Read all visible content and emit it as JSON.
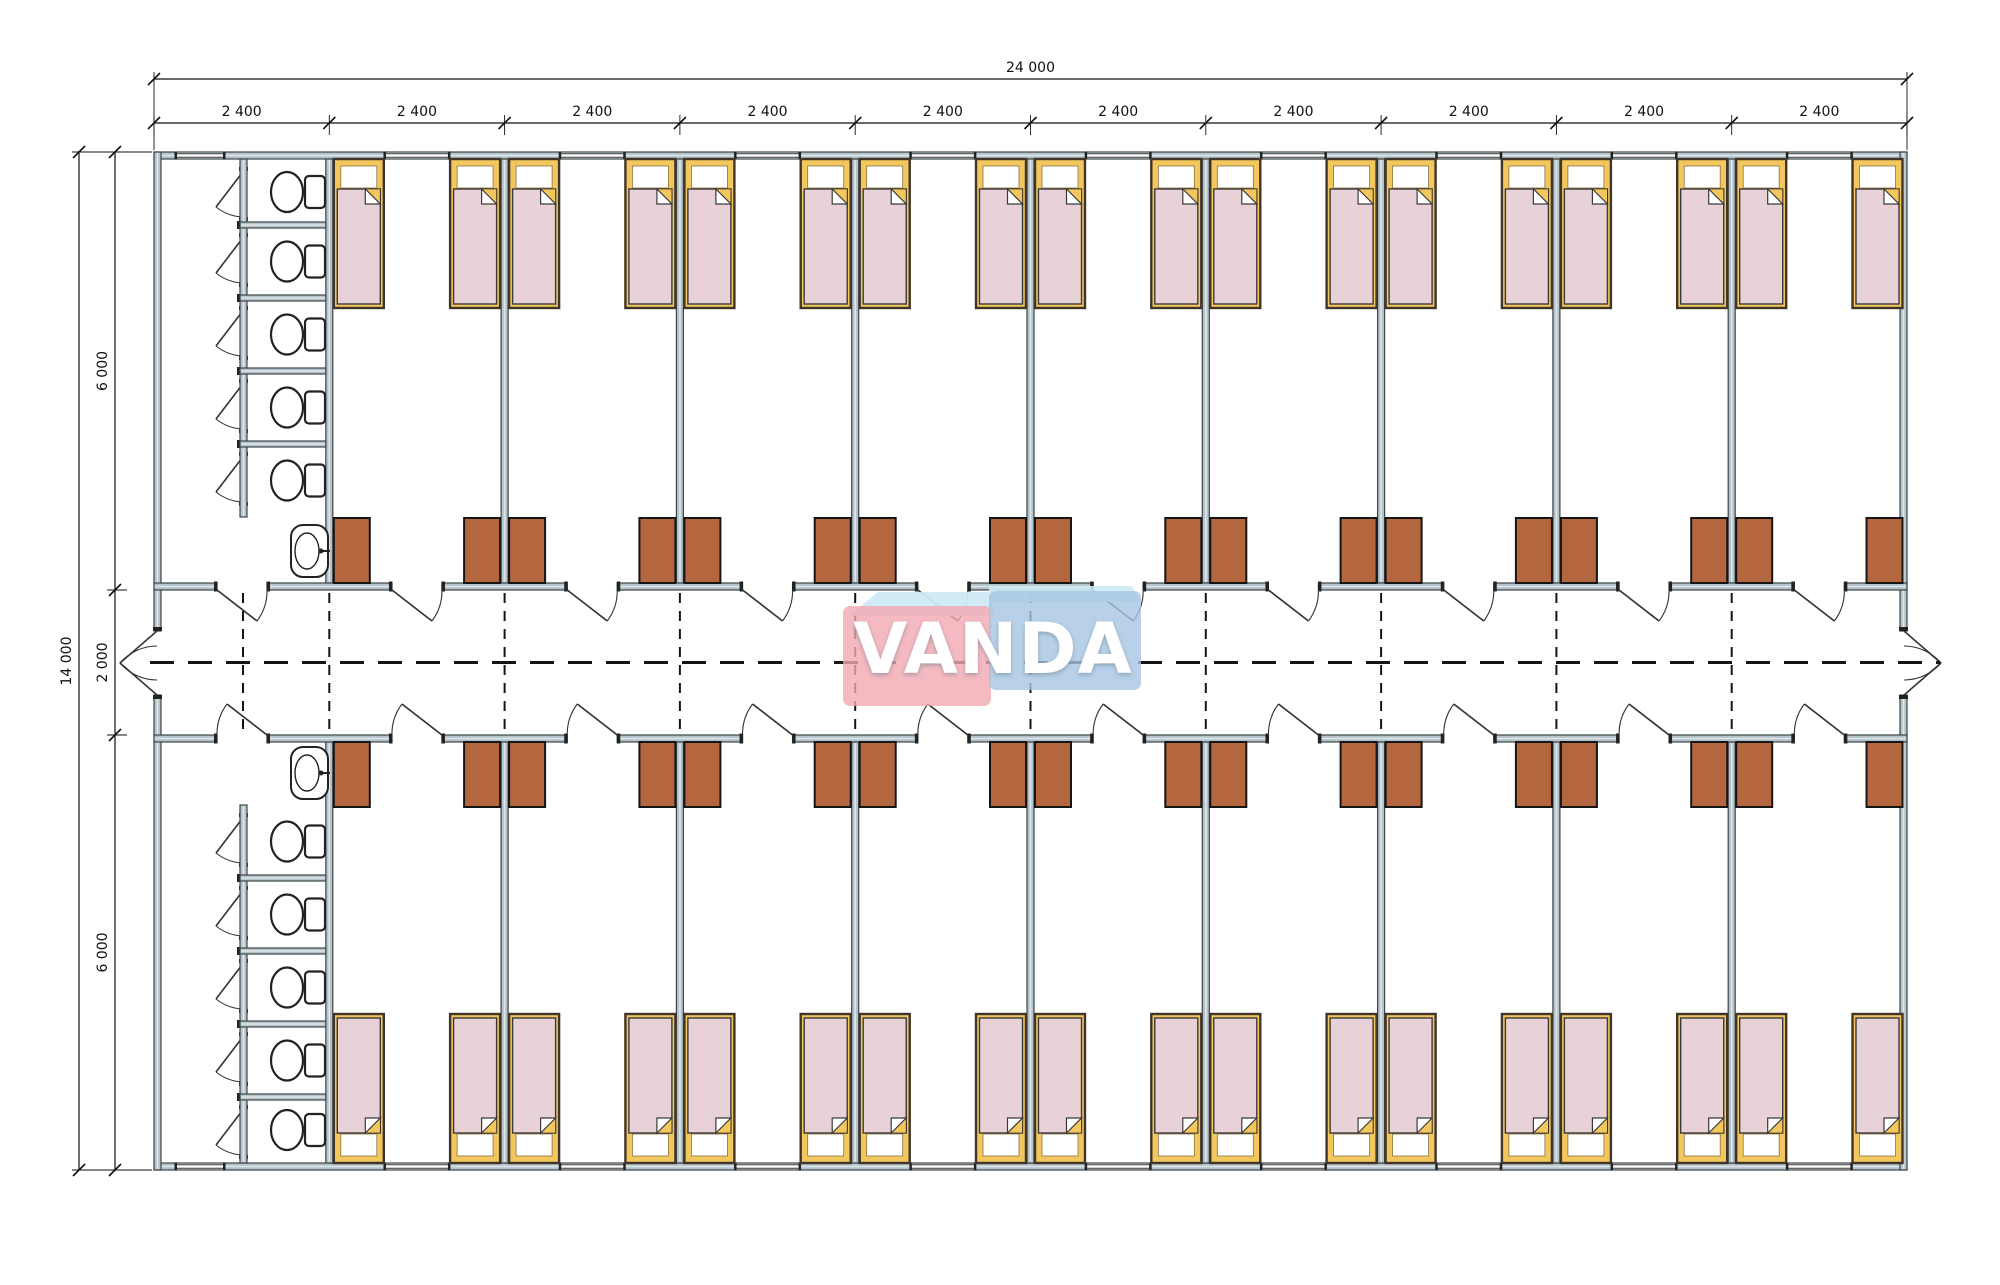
{
  "watermark": {
    "text": "VANDA"
  },
  "dimensions": {
    "top_total": "24 000",
    "top_modules": [
      "2 400",
      "2 400",
      "2 400",
      "2 400",
      "2 400",
      "2 400",
      "2 400",
      "2 400",
      "2 400",
      "2 400"
    ],
    "left_total": "14 000",
    "left_segments": [
      "6 000",
      "2 000",
      "6 000"
    ]
  },
  "counts": {
    "modules": 10,
    "rooms_per_row": 9,
    "rows": 2,
    "beds_per_room": 2,
    "wardrobes_per_room": 2,
    "bathrooms": 2,
    "toilet_stalls_per_bathroom": 5,
    "sinks_per_bathroom": 1
  },
  "colors": {
    "wall_fill": "#b4c3c9",
    "wall_core": "#dde6ea",
    "wall_line": "#3e464b",
    "bed_frame": "#f2c75e",
    "bed_frame_line": "#413428",
    "bed_head": "#ffffff",
    "blanket": "#e8d2d7",
    "blanket_line": "#3a3a3a",
    "wardrobe": "#b4663f",
    "wardrobe_line": "#151515",
    "fixture_line": "#222222",
    "door_line": "#333333",
    "dash_line": "#141414",
    "dim_line": "#111111",
    "watermark_red": "rgba(242,167,178,0.8)",
    "watermark_blue": "rgba(166,197,228,0.8)"
  }
}
